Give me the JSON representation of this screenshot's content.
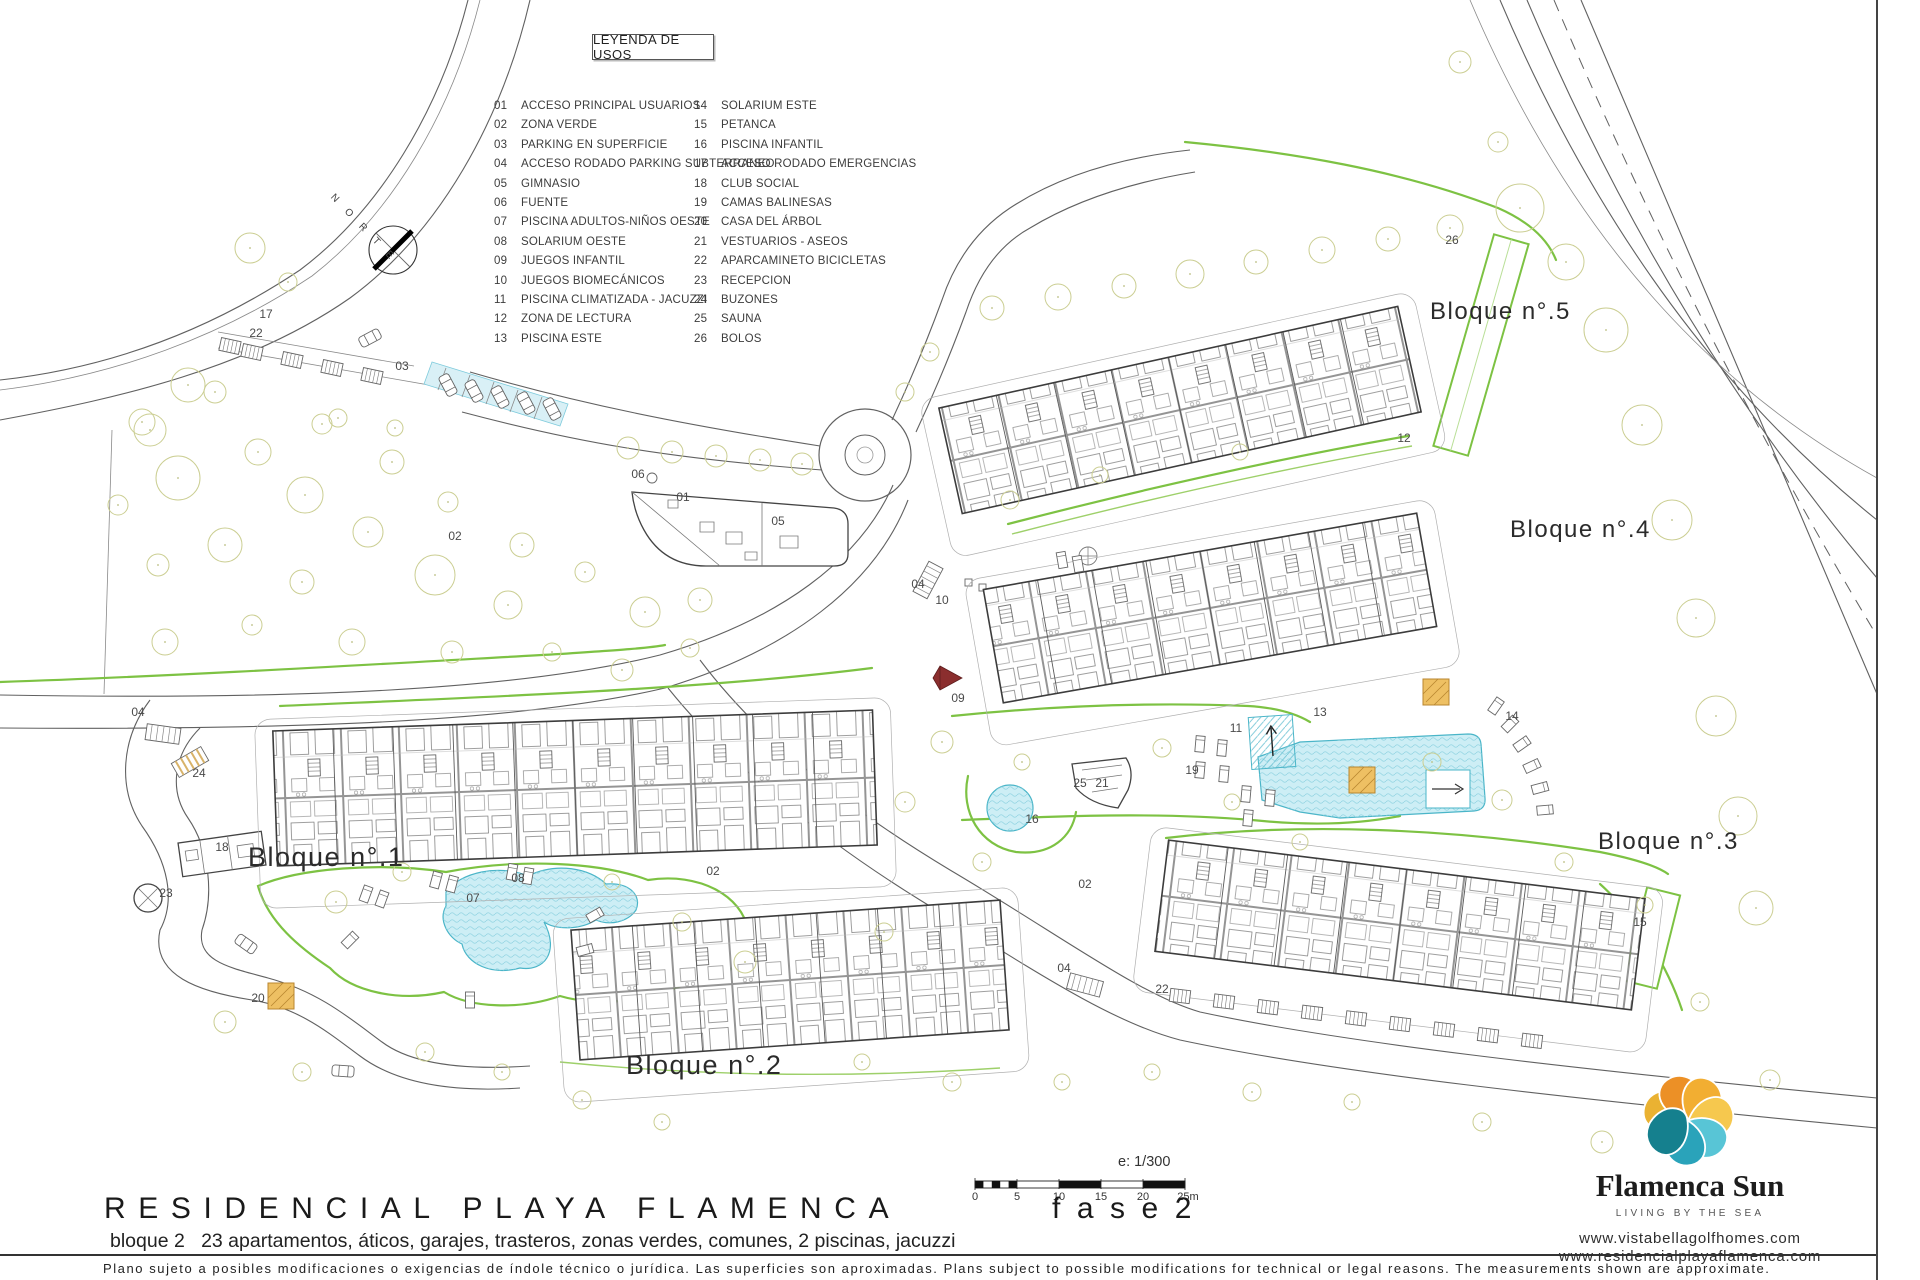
{
  "legend": {
    "title": "LEYENDA DE USOS",
    "col1": [
      {
        "n": "01",
        "label": "ACCESO PRINCIPAL USUARIOS"
      },
      {
        "n": "02",
        "label": "ZONA VERDE"
      },
      {
        "n": "03",
        "label": "PARKING EN SUPERFICIE"
      },
      {
        "n": "04",
        "label": "ACCESO RODADO PARKING SUBTERRANEO"
      },
      {
        "n": "05",
        "label": "GIMNASIO"
      },
      {
        "n": "06",
        "label": "FUENTE"
      },
      {
        "n": "07",
        "label": "PISCINA ADULTOS-NIÑOS OESTE"
      },
      {
        "n": "08",
        "label": "SOLARIUM OESTE"
      },
      {
        "n": "09",
        "label": "JUEGOS INFANTIL"
      },
      {
        "n": "10",
        "label": "JUEGOS BIOMECÁNICOS"
      },
      {
        "n": "11",
        "label": "PISCINA CLIMATIZADA - JACUZZI"
      },
      {
        "n": "12",
        "label": "ZONA DE LECTURA"
      },
      {
        "n": "13",
        "label": "PISCINA ESTE"
      }
    ],
    "col2": [
      {
        "n": "14",
        "label": "SOLARIUM ESTE"
      },
      {
        "n": "15",
        "label": "PETANCA"
      },
      {
        "n": "16",
        "label": "PISCINA INFANTIL"
      },
      {
        "n": "17",
        "label": "ACCESO RODADO EMERGENCIAS"
      },
      {
        "n": "18",
        "label": "CLUB SOCIAL"
      },
      {
        "n": "19",
        "label": "CAMAS BALINESAS"
      },
      {
        "n": "20",
        "label": "CASA DEL ÁRBOL"
      },
      {
        "n": "21",
        "label": "VESTUARIOS - ASEOS"
      },
      {
        "n": "22",
        "label": "APARCAMINETO BICICLETAS"
      },
      {
        "n": "23",
        "label": "RECEPCION"
      },
      {
        "n": "24",
        "label": "BUZONES"
      },
      {
        "n": "25",
        "label": "SAUNA"
      },
      {
        "n": "26",
        "label": "BOLOS"
      }
    ]
  },
  "plan": {
    "north_label": "N O R T E",
    "block_labels": [
      {
        "text": "Bloque n°.1",
        "x": 248,
        "y": 842,
        "size": 27
      },
      {
        "text": "Bloque n°.2",
        "x": 626,
        "y": 1050,
        "size": 27
      },
      {
        "text": "Bloque n°.3",
        "x": 1598,
        "y": 828,
        "size": 24
      },
      {
        "text": "Bloque n°.4",
        "x": 1510,
        "y": 516,
        "size": 24
      },
      {
        "text": "Bloque n°.5",
        "x": 1430,
        "y": 298,
        "size": 24
      }
    ],
    "markers": [
      {
        "id": "01",
        "x": 683,
        "y": 497
      },
      {
        "id": "02",
        "x": 455,
        "y": 536
      },
      {
        "id": "02",
        "x": 713,
        "y": 871
      },
      {
        "id": "02",
        "x": 1085,
        "y": 884
      },
      {
        "id": "03",
        "x": 402,
        "y": 366
      },
      {
        "id": "04",
        "x": 138,
        "y": 712
      },
      {
        "id": "04",
        "x": 918,
        "y": 584
      },
      {
        "id": "04",
        "x": 1064,
        "y": 968
      },
      {
        "id": "05",
        "x": 778,
        "y": 521
      },
      {
        "id": "06",
        "x": 638,
        "y": 474
      },
      {
        "id": "07",
        "x": 473,
        "y": 898
      },
      {
        "id": "08",
        "x": 518,
        "y": 878
      },
      {
        "id": "09",
        "x": 958,
        "y": 698
      },
      {
        "id": "10",
        "x": 942,
        "y": 600
      },
      {
        "id": "11",
        "x": 1236,
        "y": 728
      },
      {
        "id": "12",
        "x": 1404,
        "y": 438
      },
      {
        "id": "13",
        "x": 1320,
        "y": 712
      },
      {
        "id": "14",
        "x": 1512,
        "y": 716
      },
      {
        "id": "15",
        "x": 1640,
        "y": 922
      },
      {
        "id": "16",
        "x": 1032,
        "y": 819
      },
      {
        "id": "17",
        "x": 266,
        "y": 314
      },
      {
        "id": "18",
        "x": 222,
        "y": 847
      },
      {
        "id": "19",
        "x": 1192,
        "y": 770
      },
      {
        "id": "20",
        "x": 258,
        "y": 998
      },
      {
        "id": "21",
        "x": 1102,
        "y": 783
      },
      {
        "id": "22",
        "x": 256,
        "y": 333
      },
      {
        "id": "22",
        "x": 1162,
        "y": 989
      },
      {
        "id": "23",
        "x": 166,
        "y": 893
      },
      {
        "id": "24",
        "x": 199,
        "y": 773
      },
      {
        "id": "25",
        "x": 1080,
        "y": 783
      },
      {
        "id": "26",
        "x": 1452,
        "y": 240
      }
    ]
  },
  "scale": {
    "ratio": "e: 1/300",
    "ticks": [
      {
        "t": "0",
        "x": 975
      },
      {
        "t": "5",
        "x": 1017
      },
      {
        "t": "10",
        "x": 1059
      },
      {
        "t": "15",
        "x": 1101
      },
      {
        "t": "20",
        "x": 1143
      },
      {
        "t": "25m",
        "x": 1188
      }
    ]
  },
  "title_block": {
    "project": "RESIDENCIAL PLAYA FLAMENCA",
    "phase": "fase2",
    "subtitle": "bloque 2   23 apartamentos, áticos, garajes, trasteros, zonas verdes, comunes, 2 piscinas, jacuzzi",
    "disclaimer": "Plano sujeto a posibles modificaciones o exigencias de índole técnico o jurídica. Las superficies son aproximadas. Plans subject to possible modifications for technical or legal reasons. The measurements shown are approximate."
  },
  "brand": {
    "name": "Flamenca Sun",
    "tagline": "LIVING BY THE SEA",
    "websites": [
      "www.vistabellagolfhomes.com",
      "www.residencialplayaflamenca.com"
    ],
    "colors": {
      "logo_warm": [
        "#eab232",
        "#ec9026",
        "#f2ae32",
        "#f6c84e"
      ],
      "logo_cool": [
        "#58c5d6",
        "#2aa3ba",
        "#15808e"
      ],
      "green_zone": "#7dc243",
      "pool_fill": "#cdeef5",
      "pool_stroke": "#4ab5c8",
      "tree": "#cbce92",
      "accent_orange": "#eec063"
    }
  }
}
